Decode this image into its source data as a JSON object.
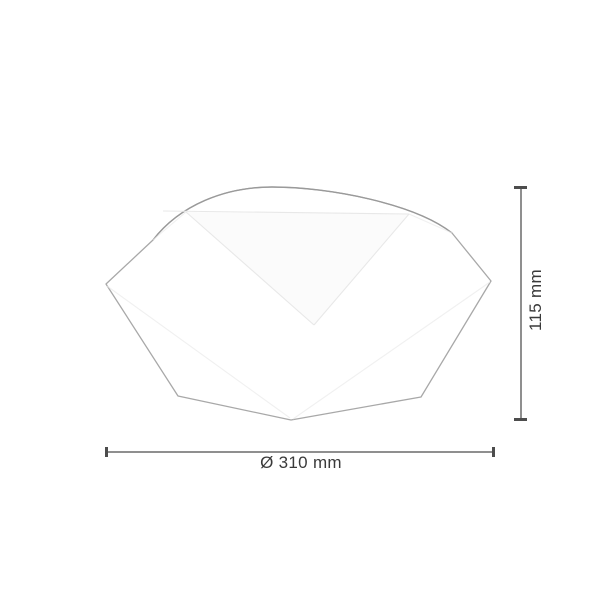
{
  "drawing": {
    "kind": "ceiling-lamp dimension drawing",
    "height_dimension": {
      "label": "115 mm"
    },
    "diameter_dimension": {
      "label": "Ø 310 mm"
    },
    "colors": {
      "background": "#ffffff",
      "outline": "#a8a8a8",
      "outline_dark": "#9a9a9a",
      "facet_line": "#e8e8e8",
      "dimension_line": "#8f8f8f",
      "dimension_tick": "#4d4d4d",
      "label_text": "#3a3a3a"
    }
  }
}
